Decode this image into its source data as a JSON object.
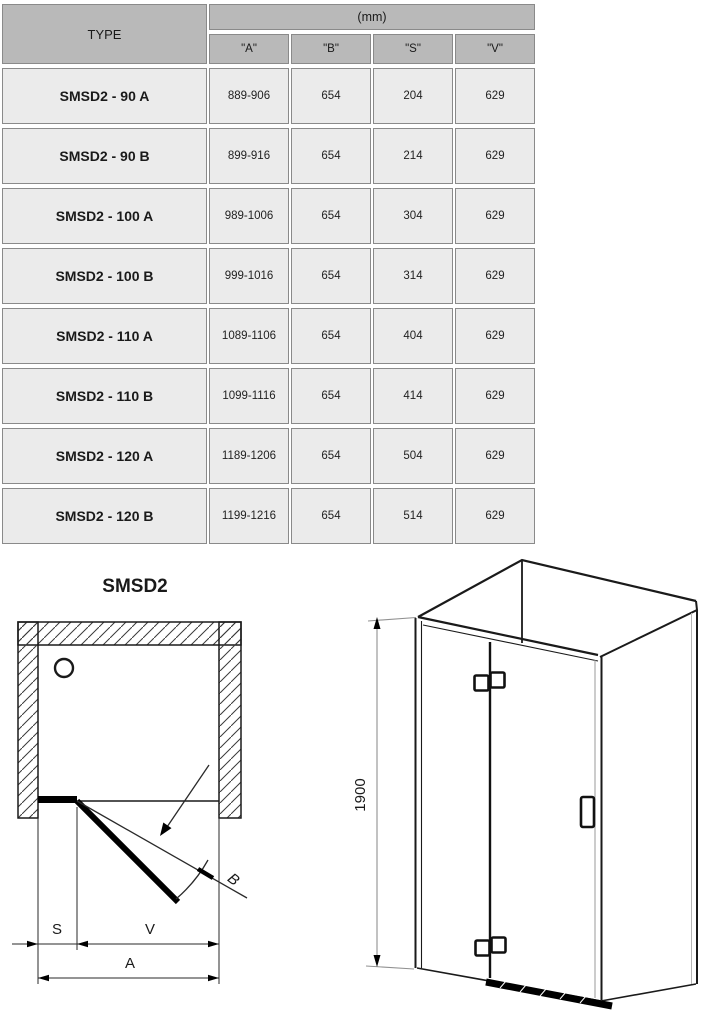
{
  "table": {
    "type_header": "TYPE",
    "unit_header": "(mm)",
    "columns": [
      "\"A\"",
      "\"B\"",
      "\"S\"",
      "\"V\""
    ],
    "rows": [
      {
        "type": "SMSD2 - 90 A",
        "a": "889-906",
        "b": "654",
        "s": "204",
        "v": "629"
      },
      {
        "type": "SMSD2 - 90 B",
        "a": "899-916",
        "b": "654",
        "s": "214",
        "v": "629"
      },
      {
        "type": "SMSD2 - 100 A",
        "a": "989-1006",
        "b": "654",
        "s": "304",
        "v": "629"
      },
      {
        "type": "SMSD2 - 100 B",
        "a": "999-1016",
        "b": "654",
        "s": "314",
        "v": "629"
      },
      {
        "type": "SMSD2 - 110 A",
        "a": "1089-1106",
        "b": "654",
        "s": "404",
        "v": "629"
      },
      {
        "type": "SMSD2 - 110 B",
        "a": "1099-1116",
        "b": "654",
        "s": "414",
        "v": "629"
      },
      {
        "type": "SMSD2 - 120 A",
        "a": "1189-1206",
        "b": "654",
        "s": "504",
        "v": "629"
      },
      {
        "type": "SMSD2 - 120 B",
        "a": "1199-1216",
        "b": "654",
        "s": "514",
        "v": "629"
      }
    ]
  },
  "plan_diagram": {
    "title": "SMSD2",
    "dim_s": "S",
    "dim_v": "V",
    "dim_a": "A",
    "dim_b": "B"
  },
  "iso_diagram": {
    "height_label": "1900"
  },
  "colors": {
    "header_bg": "#b9b9b9",
    "cell_bg": "#ebebeb",
    "border": "#8a8a8a",
    "line": "#1a1a1a"
  }
}
